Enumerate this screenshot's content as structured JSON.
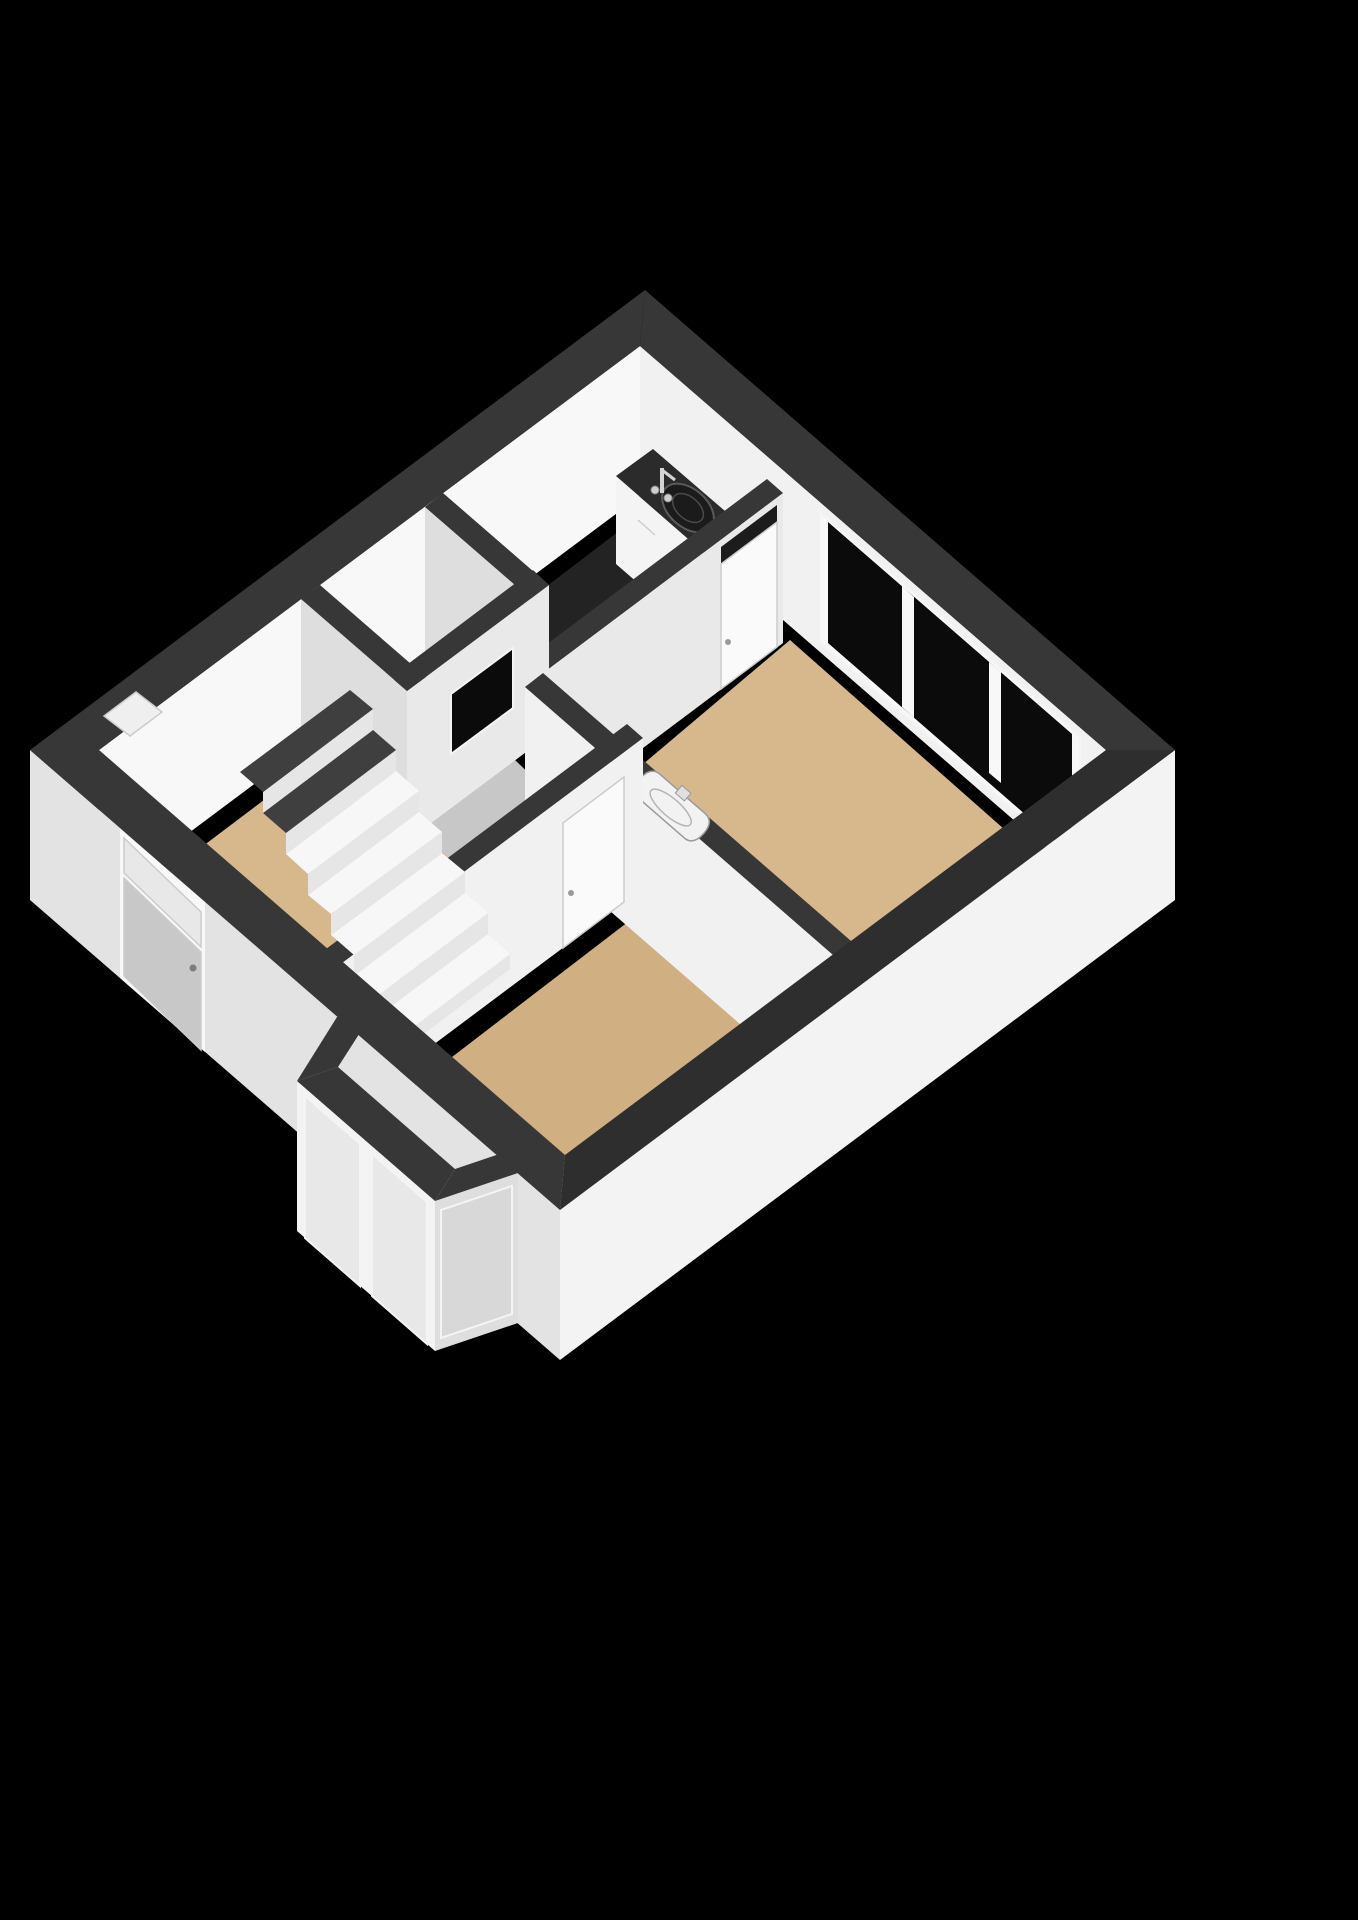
{
  "scene": {
    "kind": "3d-floor-plan-render",
    "view": "isometric-cutaway-from-above",
    "background_is_black": true,
    "rooms_count": 6
  },
  "colors": {
    "bg": "#000000",
    "band": "#373737",
    "bandDark": "#2e2e2e",
    "faceBright": "#f8f8f8",
    "faceLight": "#f1f1f1",
    "faceMid": "#e9e9e9",
    "faceDim": "#dedede",
    "faceExt": "#e3e3e3",
    "faceExtBright": "#f3f3f3",
    "floorWood": "#d7b78c",
    "floorWoodDark": "#d0af82",
    "floorGray": "#c7c7c7",
    "floorDark": "#232323",
    "counterTop": "#2b2b2b",
    "counterFront": "#f4f4f4",
    "glassDark": "#0b0b0b",
    "glassLight": "#e8e8e8",
    "glassSide": "#d8d8d8",
    "doorGray": "#c8c8c8",
    "doorWhite": "#fafafa",
    "slotDark": "#1c1c1c",
    "stepTop": "#f7f7f7",
    "stepRiser": "#e6e6e6",
    "stepCut": "#3f3f3f",
    "sinkWhite": "#f2f2f2",
    "basinDark": "#1b1b1b",
    "metal": "#c0c0c0",
    "niche": "#efefef"
  },
  "rooms": [
    {
      "name": "hall",
      "floor": "wood",
      "features": [
        "entrance-door",
        "transom-window",
        "staircase",
        "wall-niche"
      ]
    },
    {
      "name": "wc",
      "floor": "gray",
      "features": [
        "interior-window"
      ]
    },
    {
      "name": "kitchen",
      "floor": "dark-tile",
      "features": [
        "counter",
        "round-basin",
        "faucet",
        "door-with-top-slot"
      ]
    },
    {
      "name": "corridor",
      "floor": "gray",
      "features": [
        "opening-to-kitchen"
      ]
    },
    {
      "name": "bedroom-right",
      "floor": "wood",
      "features": [
        "triple-pane-window",
        "wall-basin"
      ]
    },
    {
      "name": "living-room",
      "floor": "wood",
      "features": [
        "bay-window",
        "wall-basin",
        "door-to-hall"
      ]
    }
  ],
  "staircase": {
    "visible_steps": 7,
    "cut_steps_dark_top": 2
  },
  "windows": {
    "main_window_panes": 3,
    "bay_window_panes": 4,
    "wc_interior_window_panes": 1,
    "entrance_transom_panes": 1
  },
  "fixtures": {
    "wall_basins": 2,
    "kitchen_sink": 1,
    "doors_interior": 2,
    "doors_entrance": 1
  }
}
